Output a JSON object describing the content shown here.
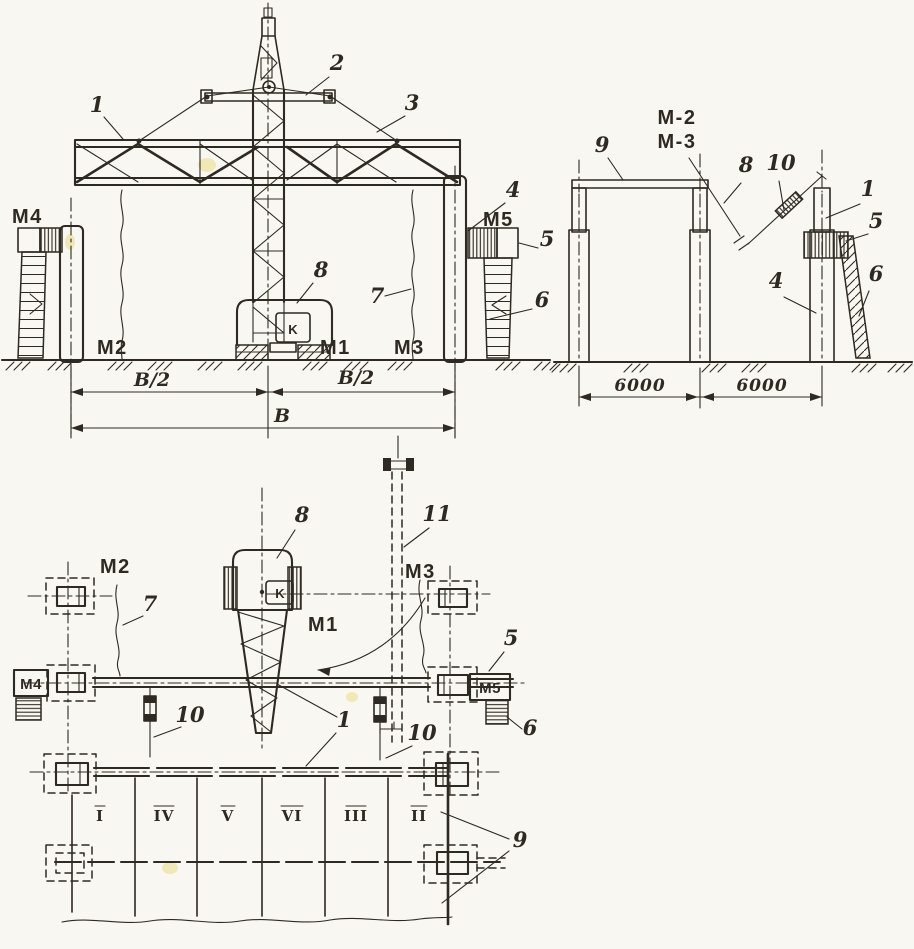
{
  "colors": {
    "ink": "#2e2922",
    "paper": "#f9f7f1",
    "stain": "#e6cf5a"
  },
  "front": {
    "c1": "1",
    "c2": "2",
    "c3": "3",
    "c4": "4",
    "c5": "5",
    "c6": "6",
    "c7": "7",
    "c8": "8",
    "m4": "M4",
    "m2": "M2",
    "m1": "M1",
    "m3": "M3",
    "m5": "M5",
    "k": "K",
    "dim_left": "B/2",
    "dim_right": "B/2",
    "dim_total": "B"
  },
  "side": {
    "c9": "9",
    "c8": "8",
    "c10": "10",
    "c1": "1",
    "c5": "5",
    "c4": "4",
    "c6": "6",
    "m_line1": "M-2",
    "m_line2": "M-3",
    "dim_left": "6000",
    "dim_right": "6000"
  },
  "plan": {
    "c8": "8",
    "c11": "11",
    "c7": "7",
    "c5": "5",
    "c6": "6",
    "c1": "1",
    "c10_left": "10",
    "c10_right": "10",
    "c9": "9",
    "m2": "M2",
    "m3": "M3",
    "m1": "M1",
    "m4": "M4",
    "m5": "M5",
    "k": "K",
    "bays": [
      "I",
      "IV",
      "V",
      "VI",
      "III",
      "II"
    ]
  }
}
